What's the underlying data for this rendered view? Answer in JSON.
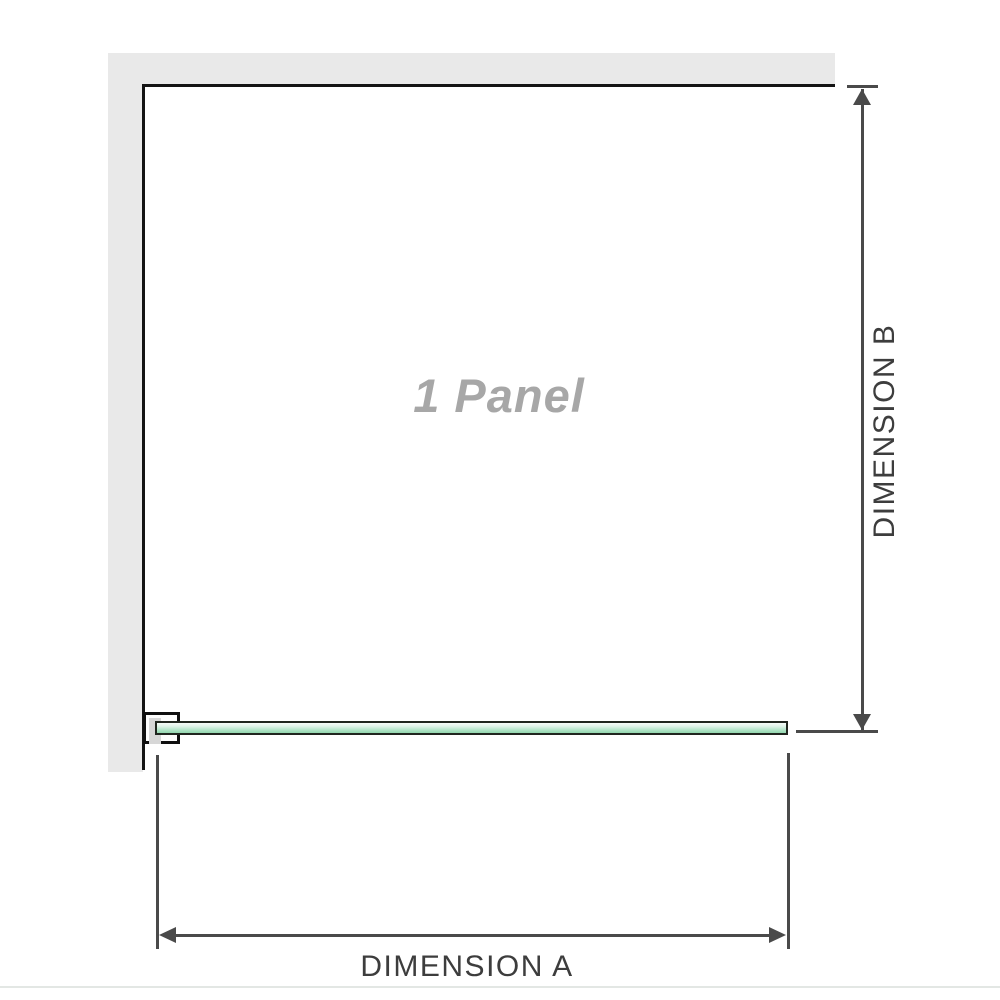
{
  "diagram": {
    "panel_label": "1 Panel",
    "dimension_a_label": "DIMENSION A",
    "dimension_b_label": "DIMENSION B"
  },
  "colors": {
    "wall-gray": "#e9e9e9",
    "outline-black": "#141414",
    "dim-gray": "#4a4a4a",
    "label-gray": "#3d3d3d",
    "panel-text-gray": "#a7a7a7",
    "glass-green": "#93d7ae",
    "glass-border": "#20261f",
    "bracket-fill": "#d7d7d7",
    "baseline-gray": "#e3e7e4"
  }
}
